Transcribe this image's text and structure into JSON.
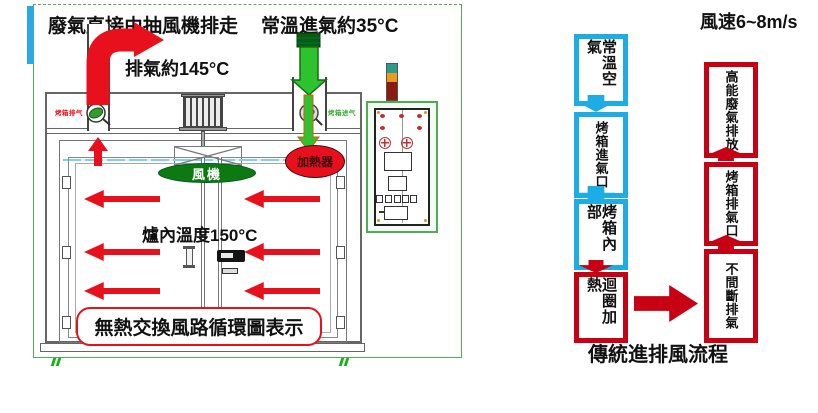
{
  "oven": {
    "exhaust_flow_title": "廢氣直接由抽風機排走",
    "intake_temp_title": "常溫進氣約35°C",
    "exhaust_temp": "排氣約145°C",
    "inner_temp": "爐內溫度150°C",
    "caption": "無熱交換風路循環圖表示",
    "fan_label": "風機",
    "heater_label": "加熱器",
    "exhaust_port_label": "烤箱排气",
    "intake_port_label": "烤箱进气"
  },
  "flowchart": {
    "wind_speed_label": "風速6~8m/s",
    "caption": "傳統進排風流程",
    "intake_sequence": [
      {
        "label": "常溫空氣"
      },
      {
        "label": "烤箱進氣口"
      },
      {
        "label": "烤箱內部"
      },
      {
        "label": "迴圈加熱"
      }
    ],
    "exhaust_sequence": [
      {
        "label": "不間斷排氣"
      },
      {
        "label": "烤箱排氣口"
      },
      {
        "label": "高能廢氣排放"
      }
    ]
  },
  "colors": {
    "cold_blue": "#1cade4",
    "hot_red": "#c70014",
    "arrow_red": "#e8101c",
    "intake_green": "#2ec22e",
    "fan_green": "#0c7a10",
    "heater_red": "#e8101c",
    "frame_green": "#55aa55",
    "cyan_bar": "#29aae1"
  }
}
